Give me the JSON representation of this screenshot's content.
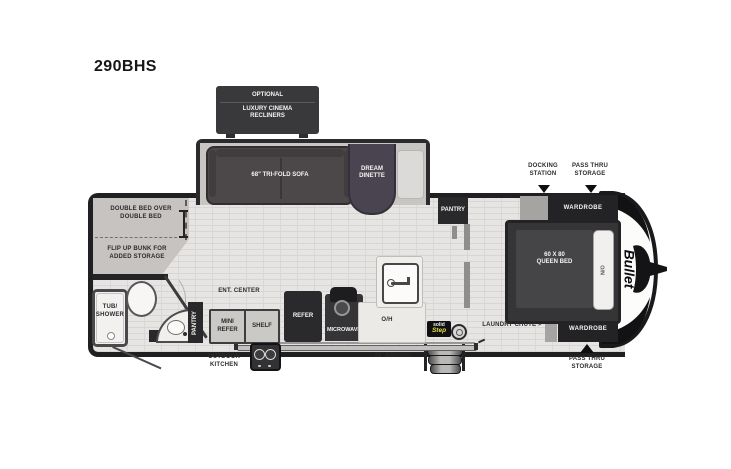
{
  "title": "290BHS",
  "colors": {
    "wall": "#232325",
    "floor": "#e6e5e3",
    "unit_dark": "#29292b",
    "slide_floor": "#c8c6c3",
    "bunk_fill": "#c6c3c0",
    "step_yellow": "#e8df3e"
  },
  "options_box": {
    "line1": "OPTIONAL",
    "line2": "LUXURY CINEMA",
    "line3": "RECLINERS"
  },
  "slide": {
    "sofa": "68\" TRI-FOLD SOFA",
    "dinette_line1": "DREAM",
    "dinette_line2": "DINETTE"
  },
  "bunk": {
    "top_line1": "DOUBLE BED OVER",
    "top_line2": "DOUBLE BED",
    "bottom_line1": "FLIP UP BUNK FOR",
    "bottom_line2": "ADDED STORAGE"
  },
  "bath": {
    "tub_line1": "TUB/",
    "tub_line2": "SHOWER"
  },
  "kitchen": {
    "pantry": "PANTRY",
    "ent_center": "ENT. CENTER",
    "mini_refer_line1": "MINI",
    "mini_refer_line2": "REFER",
    "shelf": "SHELF",
    "refer": "REFER",
    "microwave": "MICROWAVE",
    "overhead": "O/H",
    "pantry2": "PANTRY"
  },
  "bedroom": {
    "bed_line1": "60 X 80",
    "bed_line2": "QUEEN BED",
    "nightstand": "N/O",
    "wardrobe_top": "WARDROBE",
    "wardrobe_bottom": "WARDROBE",
    "laundry_chute": "LAUNDRY CHUTE >"
  },
  "callouts": {
    "docking_line1": "DOCKING",
    "docking_line2": "STATION",
    "pass_thru_top_line1": "PASS THRU",
    "pass_thru_top_line2": "STORAGE",
    "pass_thru_bottom_line1": "PASS THRU",
    "pass_thru_bottom_line2": "STORAGE"
  },
  "exterior": {
    "outdoor_kitchen_line1": "OUTDOOR",
    "outdoor_kitchen_line2": "KITCHEN",
    "awning": "21' AWNING",
    "solid_step_line1": "solid",
    "solid_step_line2": "Step",
    "brand": "Bullet"
  }
}
